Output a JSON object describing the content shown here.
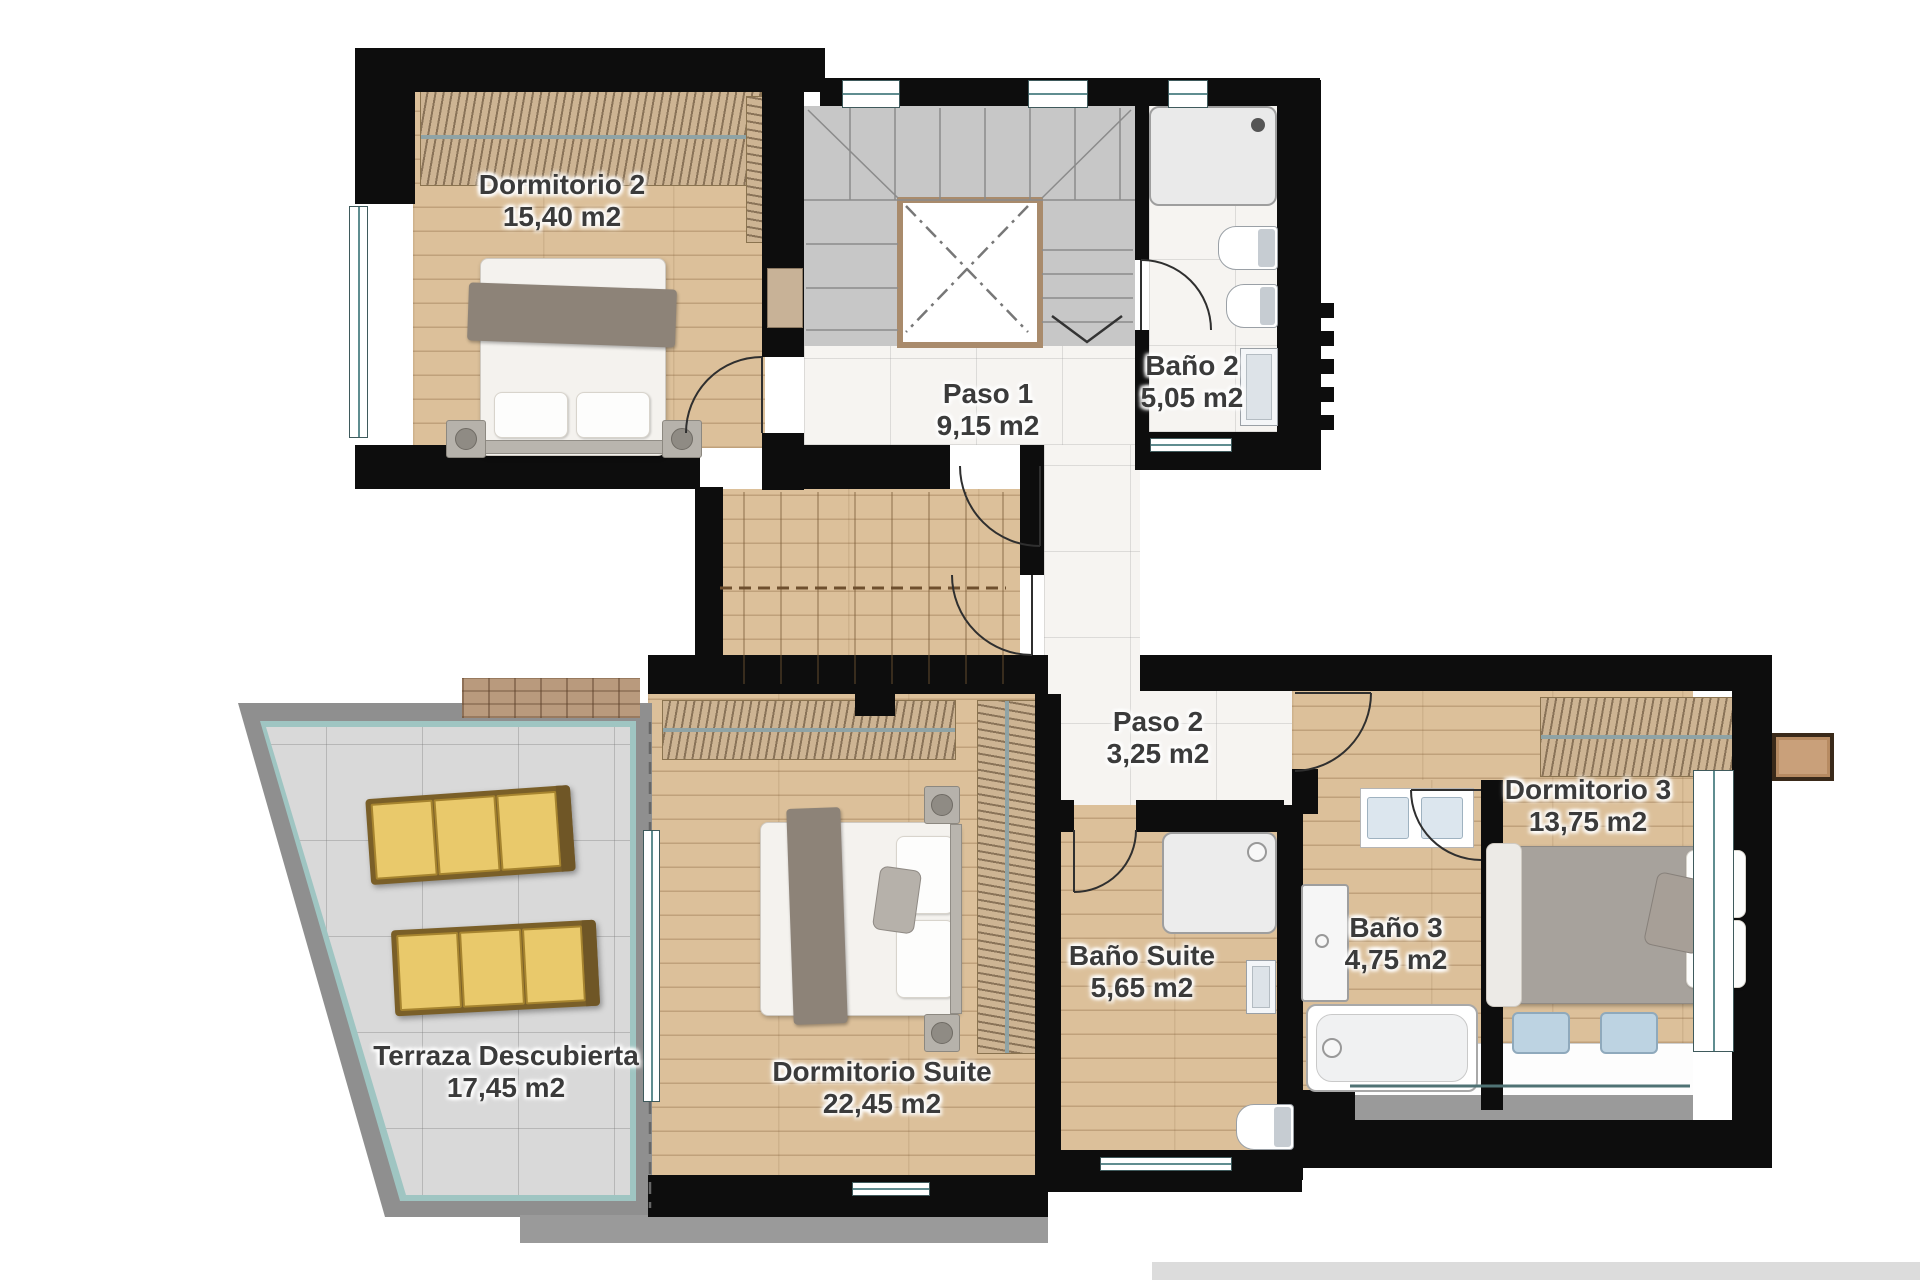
{
  "rooms": [
    {
      "id": "dormitorio-2",
      "name": "Dormitorio 2",
      "area": "15,40 m2"
    },
    {
      "id": "paso-1",
      "name": "Paso 1",
      "area": "9,15 m2"
    },
    {
      "id": "bano-2",
      "name": "Baño 2",
      "area": "5,05 m2"
    },
    {
      "id": "paso-2",
      "name": "Paso 2",
      "area": "3,25 m2"
    },
    {
      "id": "dormitorio-3",
      "name": "Dormitorio 3",
      "area": "13,75 m2"
    },
    {
      "id": "bano-3",
      "name": "Baño 3",
      "area": "4,75 m2"
    },
    {
      "id": "bano-suite",
      "name": "Baño Suite",
      "area": "5,65 m2"
    },
    {
      "id": "dormitorio-suite",
      "name": "Dormitorio Suite",
      "area": "22,45 m2"
    },
    {
      "id": "terraza-descubierta",
      "name": "Terraza Descubierta",
      "area": "17,45 m2"
    }
  ],
  "colors": {
    "wall": "#0d0d0d",
    "wood_floor": "#dcc09a",
    "marble_floor": "#f6f4f1",
    "terrace_tile": "#d9d9d9",
    "window_accent": "#5f8d90",
    "lounger_cushion": "#e9c96b",
    "label_text": "#3b3b3b"
  }
}
